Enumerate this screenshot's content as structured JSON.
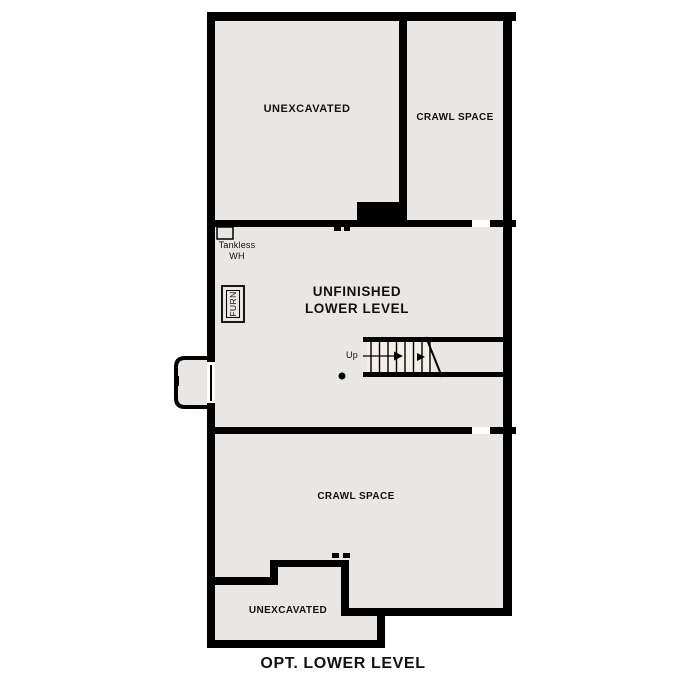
{
  "plan": {
    "caption": "OPT. LOWER LEVEL",
    "rooms": {
      "unexcavated_top": "UNEXCAVATED",
      "crawl_space_top": "CRAWL SPACE",
      "unfinished_line1": "UNFINISHED",
      "unfinished_line2": "LOWER LEVEL",
      "crawl_space_bottom": "CRAWL SPACE",
      "unexcavated_bottom": "UNEXCAVATED"
    },
    "fixtures": {
      "tankless_line1": "Tankless",
      "tankless_line2": "WH",
      "furnace": "FURN",
      "stairs_direction": "Up"
    },
    "colors": {
      "wall": "#000000",
      "room_fill": "#e8e7e3",
      "stair_fill": "#f3efe8",
      "background": "#ffffff",
      "text": "#111111"
    }
  }
}
